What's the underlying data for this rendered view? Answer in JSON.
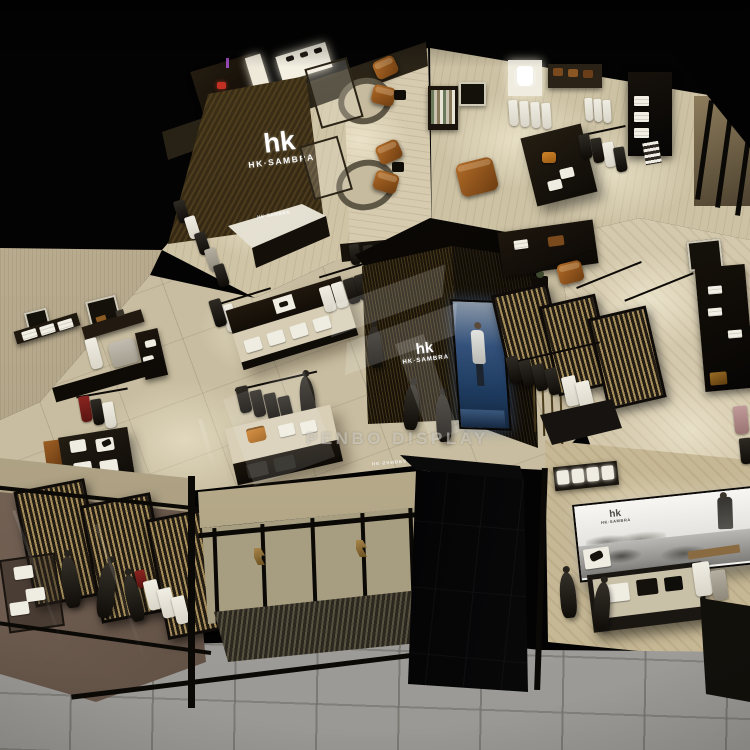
{
  "scene": {
    "title": "HK·SAMBRA menswear store — aerial 3D interior rendering",
    "view": "isometric aerial"
  },
  "brand": {
    "logo": "hk",
    "name": "HK·SAMBRA"
  },
  "signs": {
    "main_wall": {
      "logo": "hk",
      "label": "HK·SAMBRA"
    },
    "reception_desk": {
      "label": "HK·SAMBRA"
    },
    "center_kiosk": {
      "logo": "hk",
      "label": "HK·SAMBRA"
    },
    "entrance_reflection": {
      "label": "HK·SAMBRA"
    },
    "billboard": {
      "logo": "hk",
      "label": "HK·SAMBRA"
    }
  },
  "watermark": {
    "label": "PENBO DISPLAY"
  },
  "palette": {
    "void_black": "#030303",
    "floor_beige": "#c9bea2",
    "floor_light": "#d6cbaf",
    "wall_wood": "#b4a689",
    "fixture_dark": "#15100a",
    "sign_wall_bronze": "#37290f",
    "leather_cognac": "#a4601e",
    "bag_orange": "#c4761c",
    "video_screen_blue": "#2c4a72",
    "walkway_gray": "#a5a39f",
    "window_floor_mauve": "#7c655c",
    "accent_red": "#c13022"
  }
}
